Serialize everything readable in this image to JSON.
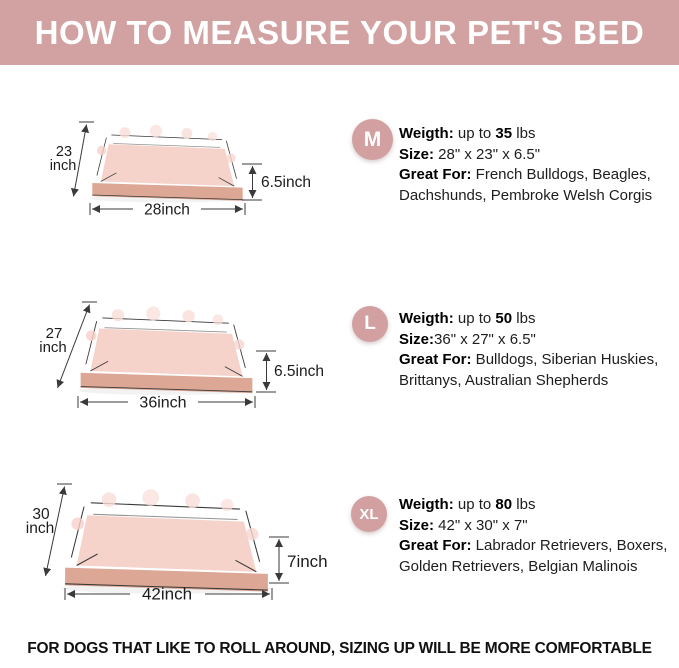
{
  "banner": {
    "title": "HOW TO MEASURE YOUR PET'S BED",
    "bg_color": "#d2a1a1",
    "text_color": "#ffffff"
  },
  "footer": {
    "note": "FOR DOGS THAT LIKE TO ROLL AROUND, SIZING UP WILL BE MORE COMFORTABLE"
  },
  "colors": {
    "accent_pink": "#d2a1a1",
    "badge_pink": "#d2a0a0",
    "bed_cushion_pink": "#f5d3cb",
    "bed_bolster_pink": "#f0c0b8",
    "bed_base_tan": "#dca794",
    "dimension_line": "#3a3a3a"
  },
  "rows": [
    {
      "badge": "M",
      "weight_label": "Weigth:",
      "weight_pre": " up to ",
      "weight_value": "35",
      "weight_post": " lbs",
      "size_label": "Size:",
      "size_value": " 28\" x 23\" x 6.5\"",
      "great_label": "Great For:",
      "great_line1": " French Bulldogs, Beagles,",
      "great_line2": "Dachshunds, Pembroke Welsh Corgis",
      "dims": {
        "side_value": "23",
        "side_unit": "inch",
        "width": "28inch",
        "height": "6.5inch"
      }
    },
    {
      "badge": "L",
      "weight_label": "Weigth:",
      "weight_pre": " up to ",
      "weight_value": "50",
      "weight_post": " lbs",
      "size_label": "Size:",
      "size_value": "36\" x 27\" x 6.5\"",
      "great_label": "Great For:",
      "great_line1": " Bulldogs, Siberian Huskies,",
      "great_line2": "Brittanys, Australian Shepherds",
      "dims": {
        "side_value": "27",
        "side_unit": "inch",
        "width": "36inch",
        "height": "6.5inch"
      }
    },
    {
      "badge": "XL",
      "weight_label": "Weigth:",
      "weight_pre": " up to ",
      "weight_value": "80",
      "weight_post": " lbs",
      "size_label": "Size:",
      "size_value": " 42\" x 30\" x 7\"",
      "great_label": "Great For:",
      "great_line1": " Labrador Retrievers, Boxers,",
      "great_line2": "Golden Retrievers, Belgian Malinois",
      "dims": {
        "side_value": "30",
        "side_unit": "inch",
        "width": "42inch",
        "height": "7inch"
      }
    }
  ]
}
